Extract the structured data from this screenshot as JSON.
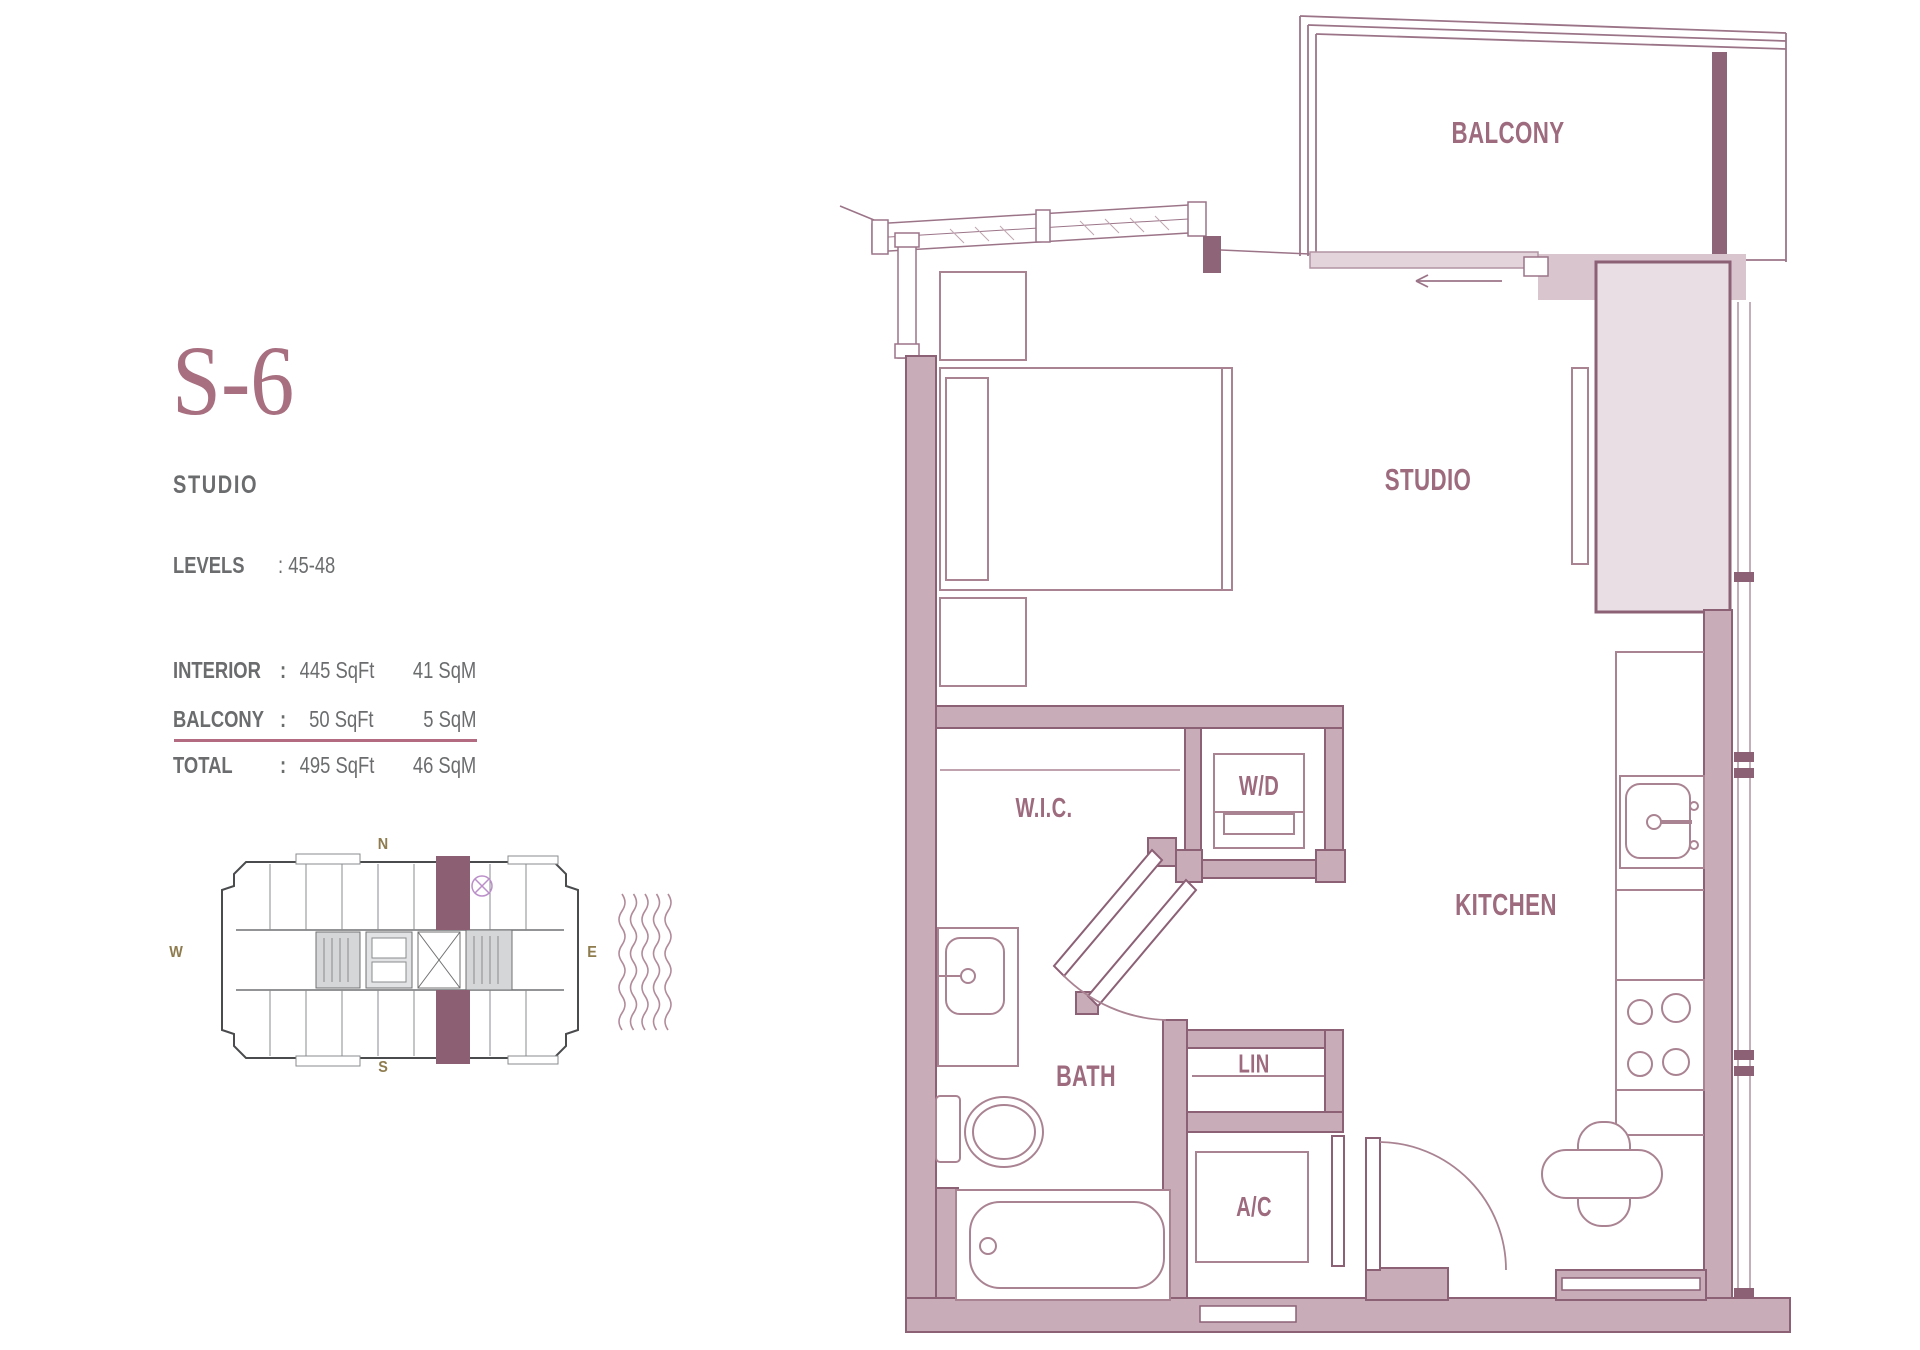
{
  "info": {
    "unit_code": "S-6",
    "unit_type": "STUDIO",
    "levels": {
      "label": "LEVELS",
      "value": ": 45-48"
    },
    "areas": {
      "rows": [
        {
          "label": "INTERIOR",
          "colon": ":",
          "sqft": "445 SqFt",
          "sqm": "41 SqM"
        },
        {
          "label": "BALCONY",
          "colon": ":",
          "sqft": "50 SqFt",
          "sqm": "5 SqM"
        },
        {
          "label": "TOTAL",
          "colon": ":",
          "sqft": "495 SqFt",
          "sqm": "46 SqM"
        }
      ]
    },
    "compass": {
      "north": "N",
      "south": "S",
      "east": "E",
      "west": "W"
    }
  },
  "plan": {
    "labels": {
      "balcony": "BALCONY",
      "studio": "STUDIO",
      "kitchen": "KITCHEN",
      "wic": "W.I.C.",
      "wd": "W/D",
      "bath": "BATH",
      "lin": "LIN",
      "ac": "A/C"
    }
  },
  "colors": {
    "title_mauve": "#a76f80",
    "label_mauve": "#9d6a7e",
    "text_gray": "#6b6c6e",
    "wall_fill": "#c8adb9",
    "wall_stroke": "#8c6075",
    "shaft_fill": "#e9dee4",
    "band_fill": "#d8c5ce",
    "furniture_line": "#aa8392",
    "compass_olive": "#8e7b4e",
    "separator": "#b26b80",
    "keyplan_highlight": "#8c5f72"
  }
}
